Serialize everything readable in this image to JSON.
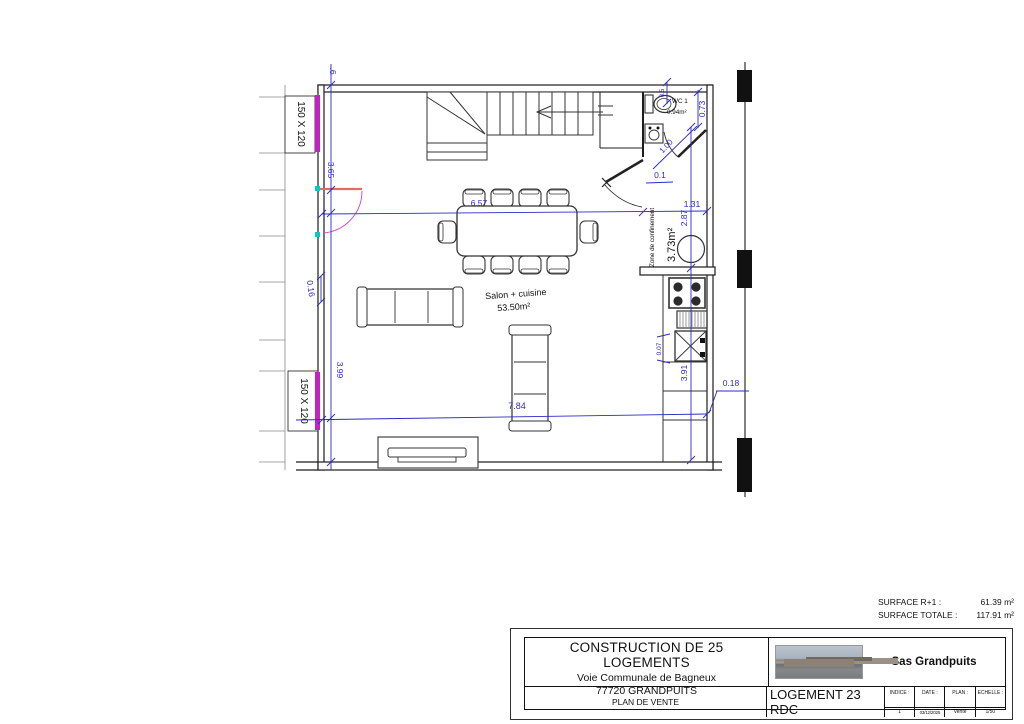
{
  "page": {
    "background": "#ffffff"
  },
  "colors": {
    "dimension_blue": "#2a2ac9",
    "window_magenta": "#c322c3",
    "door_red": "#e46a6a",
    "grip_cyan": "#19c2c2",
    "wall_black": "#1c1c1c"
  },
  "plan": {
    "rooms": {
      "salon_name": "Salon + cuisine",
      "salon_area": "53.50m²",
      "zone_name": "Zone de confinement",
      "zone_area": "3.73m²",
      "wc_name": "WC 1",
      "wc_area": "0.94m²"
    },
    "windows": {
      "upper": "150 X 120",
      "lower": "150 X 120"
    },
    "dims": {
      "top_partial": ".6",
      "left_upper": "3.65",
      "left_small": "0.16",
      "left_lower": "3.99",
      "width_main": "6.57",
      "width_zone": "1.31",
      "width_total": "7.84",
      "wc_width": "0.5",
      "wc_height": "0.73",
      "door_diag": "1.00",
      "zone_door": "0.1",
      "right_upper": "2.87",
      "right_lower": "3.91",
      "sink_offset": "0.07",
      "wall_offset": "0.18"
    }
  },
  "surfaces": {
    "r1_label": "SURFACE R+1 :",
    "r1_value": "61.39 m²",
    "total_label": "SURFACE TOTALE :",
    "total_value": "117.91 m²"
  },
  "title_block": {
    "project": "CONSTRUCTION DE 25 LOGEMENTS",
    "address_line1": "Voie Communale de Bagneux",
    "address_line2": "77720 GRANDPUITS",
    "doc_type": "PLAN DE VENTE",
    "unit": "LOGEMENT 23 RDC",
    "company": "Sas Grandpuits",
    "indice_label": "INDICE :",
    "indice_value": "1",
    "date_label": "DATE :",
    "date_value": "03/12/2025",
    "plan_label": "PLAN :",
    "plan_value": "Vente",
    "echelle_label": "ECHELLE :",
    "echelle_value": "1/50"
  }
}
